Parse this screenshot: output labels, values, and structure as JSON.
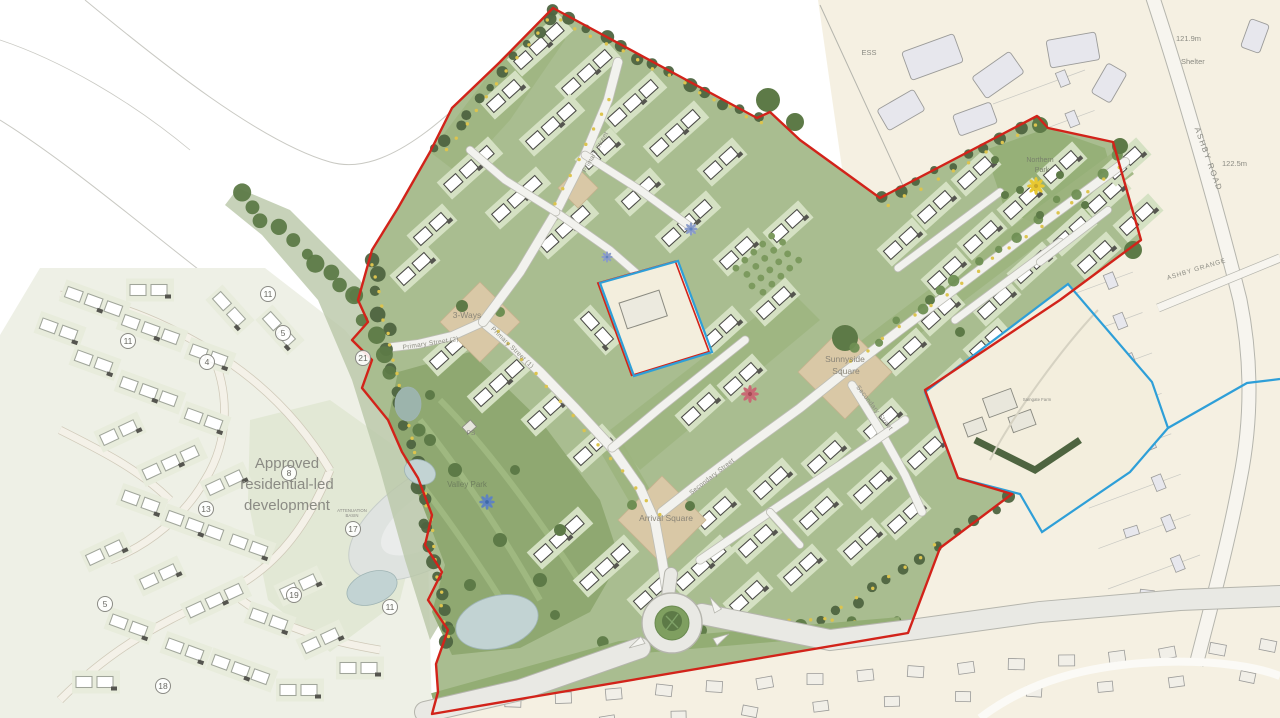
{
  "title": "Residential development masterplan",
  "labels": {
    "approved_line1": "Approved",
    "approved_line2": "residential-led",
    "approved_line3": "development",
    "northern_park_1": "Northern",
    "northern_park_2": "Park",
    "sunnyside_1": "Sunnyside",
    "sunnyside_2": "Square",
    "arrival_square": "Arrival Square",
    "three_ways": "3-Ways",
    "valley_park": "Valley Park",
    "attenuation_1": "ATTENUATION",
    "attenuation_2": "BASIN",
    "ps": "PS",
    "ess": "ESS",
    "shelter": "Shelter",
    "spot_height_a": "121.9m",
    "spot_height_b": "122.5m",
    "ashby_road": "ASHBY ROAD",
    "ashby_grange": "ASHBY GRANGE",
    "farm": "Samgate Farm",
    "primary_street_1": "Primary Street (1)",
    "primary_street_2": "Primary Street (2)",
    "primary_street_top": "Primary Street",
    "secondary_street_a": "Secondary Street",
    "secondary_street_b": "Secondary Street"
  },
  "markers": [
    {
      "value": "11",
      "x": 268,
      "y": 294
    },
    {
      "value": "11",
      "x": 128,
      "y": 341
    },
    {
      "value": "5",
      "x": 283,
      "y": 333
    },
    {
      "value": "4",
      "x": 207,
      "y": 362
    },
    {
      "value": "21",
      "x": 363,
      "y": 358
    },
    {
      "value": "8",
      "x": 289,
      "y": 473
    },
    {
      "value": "13",
      "x": 206,
      "y": 509
    },
    {
      "value": "17",
      "x": 353,
      "y": 529
    },
    {
      "value": "19",
      "x": 294,
      "y": 595
    },
    {
      "value": "11",
      "x": 390,
      "y": 607
    },
    {
      "value": "5",
      "x": 105,
      "y": 604
    },
    {
      "value": "18",
      "x": 163,
      "y": 686
    }
  ],
  "colors": {
    "red_boundary": "#d2231a",
    "blue_boundary": "#2e9fd8",
    "site_green": "#a9bd90",
    "buffer_green": "#9cb47e",
    "parcel_green": "#d5e1c3",
    "parcel_pale": "#e8ecdc",
    "park_green": "#8fa871",
    "park_light": "#a3bb84",
    "square_tan": "#d9c8a6",
    "existing_beige": "#f5f0e2",
    "field_pale": "#dde4cf",
    "dev_pale": "#eef0e6",
    "building_grey": "#e7e7ed",
    "building_stroke": "#9b9b99",
    "house_stroke": "#4a4a46",
    "house_stroke_lt": "#a0a59a",
    "road_fill": "#f2f2ee",
    "road_case": "#bdbdb5",
    "big_road_fill": "#e9e9e4",
    "big_road_case": "#b5b5ad",
    "cream": "#f3eedd",
    "pond": "#c2d3d3",
    "pond_stroke": "#9fb4b4",
    "basin": "#dfe3e0",
    "tree_dark": "#4e6440",
    "tree_mid": "#5d7a47",
    "tree_light": "#6f8f53",
    "dot_yellow": "#dcc44e",
    "flower_yellow": "#e8c832",
    "flower_pink": "#c96a74",
    "flower_blue": "#5f83c0",
    "faint_line": "#c9c9c3",
    "marker_stroke": "#8a8a84",
    "marker_text": "#6a6a64"
  }
}
